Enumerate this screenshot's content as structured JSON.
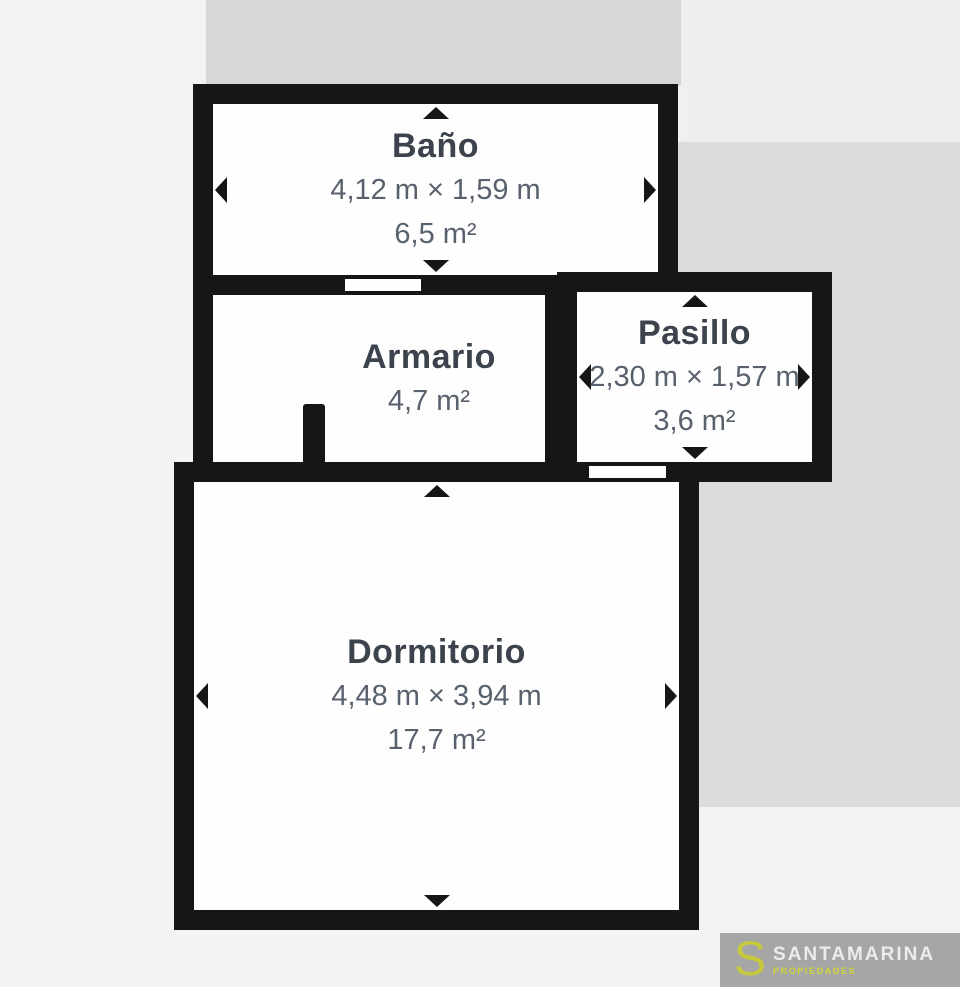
{
  "plan": {
    "rooms": [
      {
        "id": "bano",
        "name": "Baño",
        "dimensions": "4,12 m × 1,59 m",
        "area": "6,5 m²"
      },
      {
        "id": "armario",
        "name": "Armario",
        "area": "4,7 m²"
      },
      {
        "id": "pasillo",
        "name": "Pasillo",
        "dimensions": "2,30 m × 1,57 m",
        "area": "3,6 m²"
      },
      {
        "id": "dormitorio",
        "name": "Dormitorio",
        "dimensions": "4,48 m × 3,94 m",
        "area": "17,7 m²"
      }
    ]
  },
  "logo": {
    "monogram": "S",
    "name": "SANTAMARINA",
    "tagline": "PROPIEDADES"
  },
  "colors": {
    "wall": "#161616",
    "room_fill": "#fefefe",
    "room_name_text": "#3c434c",
    "room_measure_text": "#59616e",
    "page_background": "#f3f3f3",
    "background_block_top": "#d7d7d7",
    "background_block_right": "#dcdcdc",
    "background_block_top_right": "#efefef",
    "logo_box": "#a6a6a6",
    "logo_accent": "#c6c93c",
    "logo_name_text": "#ececec"
  }
}
